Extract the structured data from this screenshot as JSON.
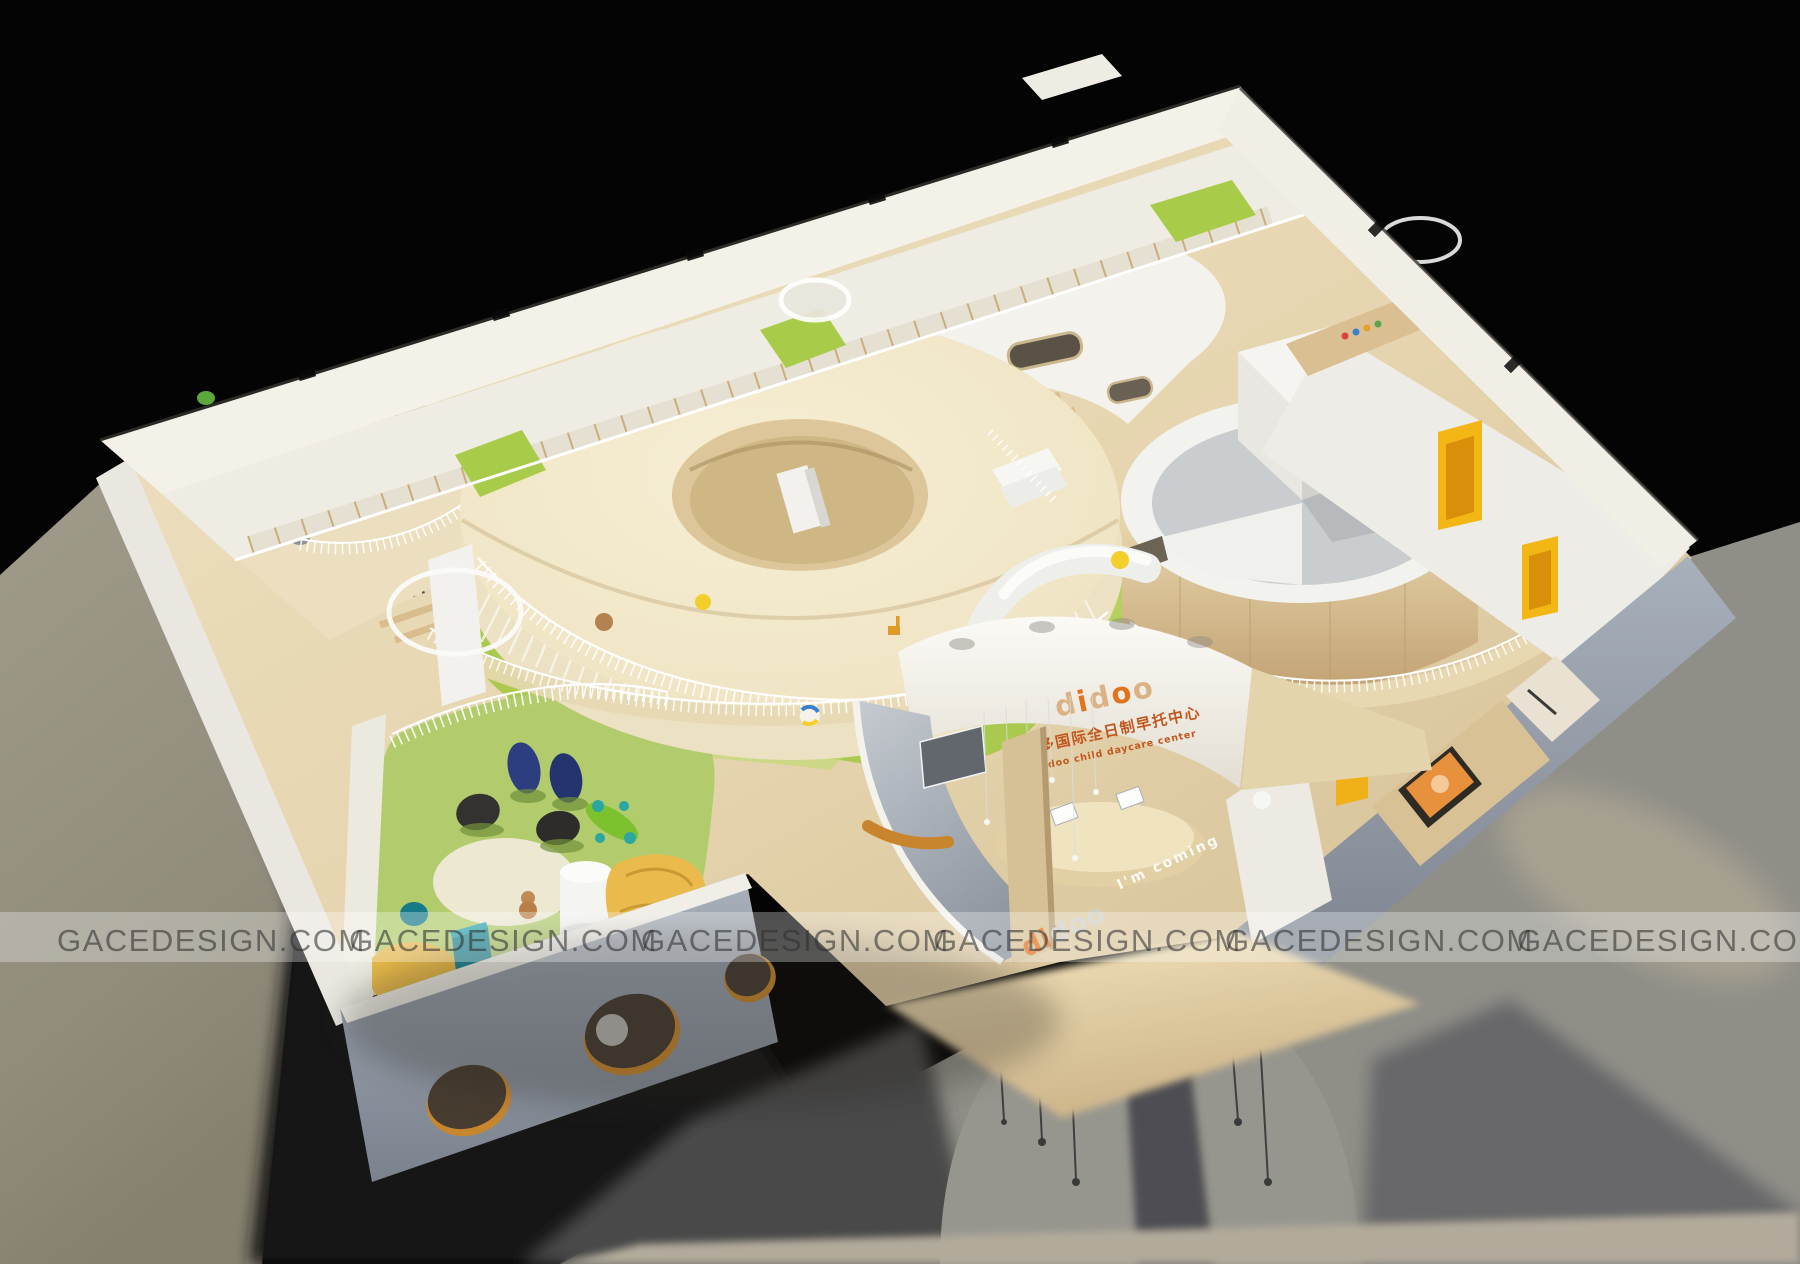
{
  "watermark": {
    "text": "GACEDESIGN.COM",
    "count": 6
  },
  "signage": {
    "logo_letters": [
      "d",
      "i",
      "d",
      "o",
      "o"
    ],
    "chinese": "迪多国际全日制早托中心",
    "english": "Didoo child daycare center",
    "entrance_logo_letters": [
      "d",
      "i",
      "d",
      "o",
      "o"
    ],
    "entrance_tagline": "I'm coming"
  },
  "palette": {
    "background": "#000000",
    "ground_left": "#9a9585",
    "ground_right": "#8f8e87",
    "cast_shadow": "#4a4a4c",
    "wood_floor": "#e5d6b2",
    "wood_dark": "#c8ab7c",
    "donut_cream": "#f2e8c9",
    "carpet_green": "#abc94e",
    "carpet_green_light": "#c3d977",
    "wall_white": "#f3f0e8",
    "wall_gray_blue": "#9aa2ab",
    "door_yellow": "#f3b715",
    "brand_orange": "#e0731c",
    "beanbag_navy": "#2c3d80",
    "beanbag_black": "#343230",
    "stool_teal": "#1f8896",
    "sofa_yellow": "#eaba4c",
    "slat_dark": "#2f2b25"
  }
}
